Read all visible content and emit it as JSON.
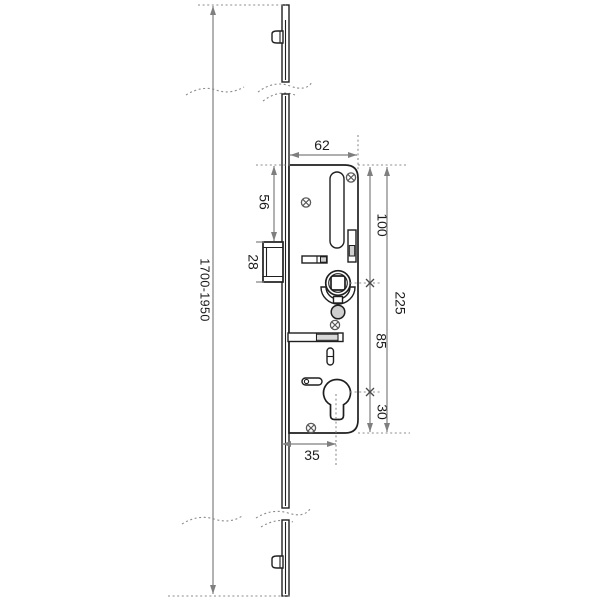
{
  "dimensions": {
    "total_length": "1700-1950",
    "case_width": "62",
    "top_to_latch": "56",
    "latch_height": "28",
    "top_to_follower": "100",
    "case_height": "225",
    "follower_to_cylinder": "85",
    "cylinder_to_bottom": "30",
    "backset": "35"
  },
  "colors": {
    "line": "#1f1f1f",
    "dimension": "#7f7f7f",
    "reference": "#8c8c8c",
    "fill_light": "#d9d9d9",
    "fill_mid": "#cfcfcf",
    "background": "#ffffff"
  }
}
